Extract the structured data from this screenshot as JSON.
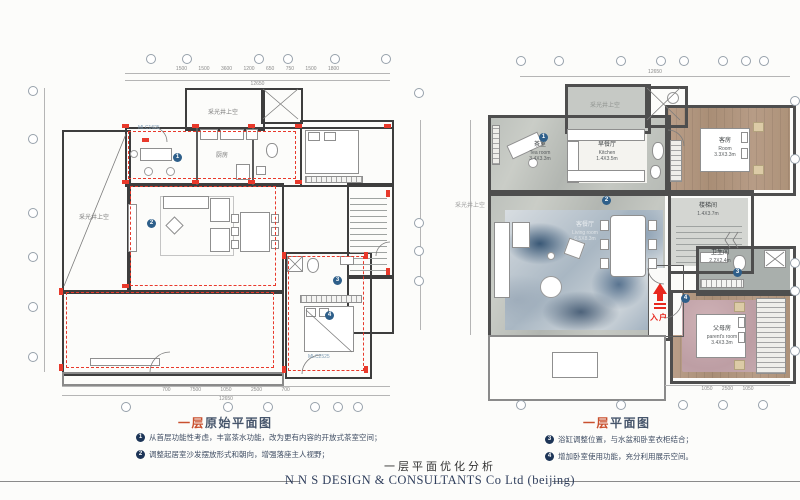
{
  "page": {
    "bottom_title": "一层平面优化分析",
    "footer": "N N S DESIGN & CONSULTANTS Co Ltd (beijing)"
  },
  "markers": {
    "m1": "1",
    "m2": "2",
    "m3": "3",
    "m4": "4"
  },
  "left_plan": {
    "caption": {
      "highlight": "一层",
      "rest": "原始平面图"
    },
    "notes": [
      {
        "num": "1",
        "text": "从首层功能性考虑，丰富茶水功能，改为更有内容的开放式茶室空间；"
      },
      {
        "num": "2",
        "text": "调整起居室沙发摆放形式和朝向，增强落座主人视野；"
      }
    ],
    "labels": {
      "light_well_top": "采光井上空",
      "light_well_left": "采光井上空",
      "kitchen": "厨房",
      "window_tag_top": "MLC1625",
      "window_tag_bottom": "MLC2525"
    },
    "dims": {
      "top_segments": "1500 1500 3600 1200 650 750 1500 1800",
      "top_total": "12650",
      "bottom_segments": "700 7500 1050 2500 700",
      "bottom_total": "12650"
    }
  },
  "right_plan": {
    "caption": {
      "highlight": "一层",
      "rest": "平面图"
    },
    "notes": [
      {
        "num": "3",
        "text": "浴缸调整位置，与水盆和卧室衣柜结合；"
      },
      {
        "num": "4",
        "text": "增加卧室使用功能，充分利用展示空间。"
      }
    ],
    "rooms": {
      "tea": {
        "zh": "茶室",
        "en": "Tea room",
        "size": "3.4X3.3m"
      },
      "breakfast": {
        "zh": "早餐厅",
        "en": "Kitchen",
        "size": "1.4X3.5m"
      },
      "guest": {
        "zh": "客房",
        "en": "Room",
        "size": "3.3X3.3m"
      },
      "stair": {
        "zh": "楼梯间",
        "en": "Staircase",
        "size": "1.4X3.7m"
      },
      "living": {
        "zh": "客餐厅",
        "en": "Living room",
        "size": "6.5X8.3m"
      },
      "bath": {
        "zh": "卫生间",
        "en": "Bathroom",
        "size": "2.2X2.4m"
      },
      "parent": {
        "zh": "父母房",
        "en": "parent's room",
        "size": "3.4X3.3m"
      },
      "light_well_top": "采光井上空",
      "light_well_left": "采光井上空"
    },
    "entry_label": "入户",
    "dims": {
      "top_total": "12650",
      "bottom_segments": "1050 2500 1050"
    }
  },
  "colors": {
    "accent_red": "#e8392b",
    "marker_blue": "#2e5f8a",
    "caption_orange": "#c9502e"
  }
}
